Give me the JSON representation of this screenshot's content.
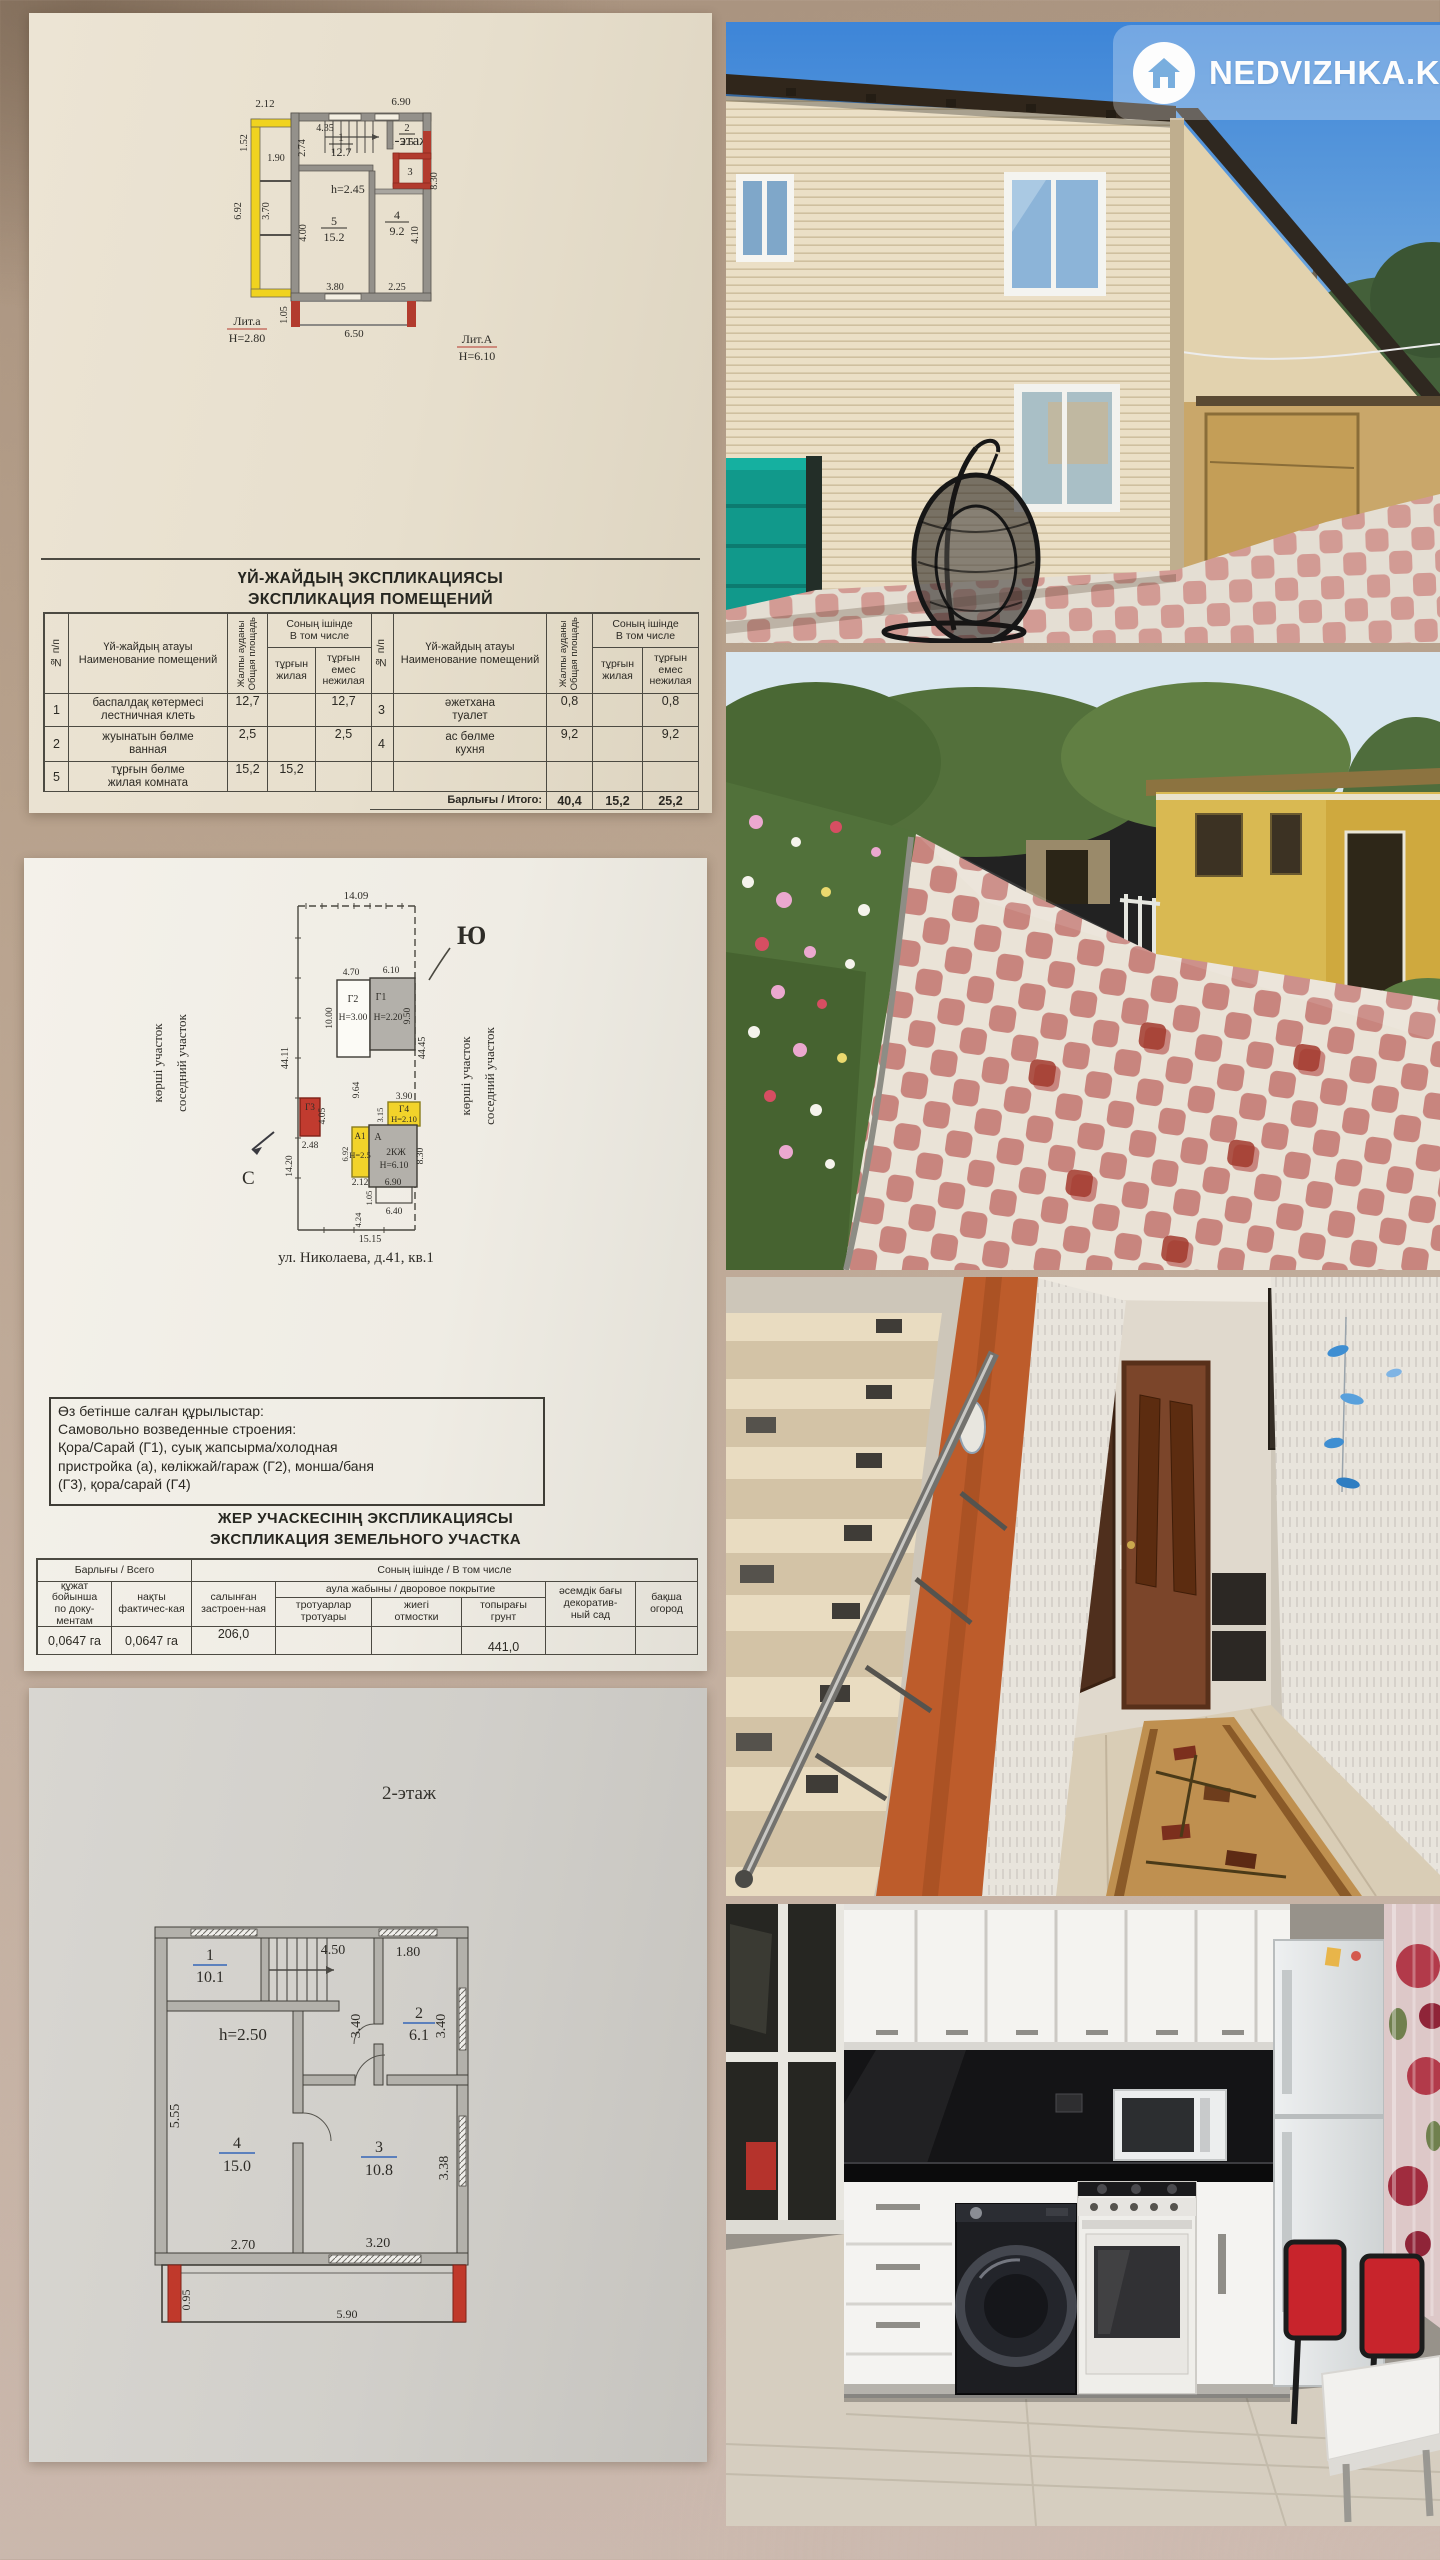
{
  "watermark": {
    "brand": "NEDVIZHKA.KZ"
  },
  "doc1": {
    "plan_title": "1-этаж",
    "labels": {
      "height_note": "h=2.45",
      "lit_small": "Лит.а",
      "lit_small_h": "Н=2.80",
      "lit_big": "Лит.А",
      "lit_big_h": "Н=6.10"
    },
    "rooms": {
      "r1_num": "1",
      "r1_area": "12.7",
      "r2_num": "2",
      "r2_area": "2.5",
      "r3_num": "3",
      "r4_num": "4",
      "r4_area": "9.2",
      "r5_num": "5",
      "r5_area": "15.2"
    },
    "dims": {
      "d212": "2.12",
      "d690": "6.90",
      "d152": "1.52",
      "d190": "1.90",
      "d692": "6.92",
      "d370": "3.70",
      "d435": "4.35",
      "d274": "2.74",
      "d400": "4.00",
      "d380": "3.80",
      "d225": "2.25",
      "d830": "8.30",
      "d410": "4.10",
      "d105": "1.05",
      "d650": "6.50"
    },
    "table": {
      "title1": "ҮЙ-ЖАЙДЫҢ ЭКСПЛИКАЦИЯСЫ",
      "title2": "ЭКСПЛИКАЦИЯ ПОМЕЩЕНИЙ",
      "h_no": "№ п/п",
      "h_name": "Үй-жайдың атауы\nНаименование помещений",
      "h_area": "Жалпы ауданы\nОбщая площадь",
      "h_incl": "Соның ішінде\nВ том числе",
      "h_living": "тұрғын\nжилая",
      "h_nonliving": "тұрғын емес\nнежилая",
      "left_rows": [
        {
          "num": "1",
          "name": "баспалдақ көтермесі\nлестничная клеть",
          "total": "12,7",
          "living": "",
          "nonliving": "12,7"
        },
        {
          "num": "2",
          "name": "жуынатын бөлме\nванная",
          "total": "2,5",
          "living": "",
          "nonliving": "2,5"
        },
        {
          "num": "5",
          "name": "тұрғын бөлме\nжилая комната",
          "total": "15,2",
          "living": "15,2",
          "nonliving": ""
        }
      ],
      "right_rows": [
        {
          "num": "3",
          "name": "әжетхана\nтуалет",
          "total": "0,8",
          "living": "",
          "nonliving": "0,8"
        },
        {
          "num": "4",
          "name": "ас бөлме\nкухня",
          "total": "9,2",
          "living": "",
          "nonliving": "9,2"
        }
      ],
      "total_label": "Барлығы / Итого:",
      "totals": {
        "all": "40,4",
        "living": "15,2",
        "nonliving": "25,2"
      }
    }
  },
  "doc2": {
    "south": "Ю",
    "north": "С",
    "neighbor_kz": "көрші участок",
    "neighbor_ru": "соседний участок",
    "dims": {
      "top": "14.09",
      "left": "44.11",
      "right": "44.45",
      "g2w": "4.70",
      "g1w": "6.10",
      "g2d": "10.00",
      "g1d": "9.50",
      "mid": "9.64",
      "g3w": "2.48",
      "g3d": "4.05",
      "left2": "14.20",
      "g4w": "3.90",
      "g4d": "3.15",
      "a1d": "6.92",
      "a1w": "2.12",
      "aw": "6.90",
      "ad": "8.30",
      "ph": "1.05",
      "pw": "6.40",
      "bl": "4.24",
      "bottom": "15.15"
    },
    "bld": {
      "g1": "Г1",
      "g1h": "Н=2.20",
      "g2": "Г2",
      "g2h": "Н=3.00",
      "g3": "Г3",
      "g4": "Г4",
      "g4h": "Н=2.10",
      "a1": "А1",
      "a1h": "Н=2.5",
      "a": "А",
      "atype": "2КЖ",
      "ah": "Н=6.10"
    },
    "caption": "ул. Николаева, д.41, кв.1",
    "note": {
      "l1": "Өз бетінше салған құрылыстар:",
      "l2": "Самовольно возведенные строения:",
      "l3": " Қора/Сарай (Г1), суық жапсырма/холодная",
      "l4": "пристройка (а), көлікжай/гараж (Г2), монша/баня",
      "l5": "(Г3), қора/сарай (Г4)"
    },
    "table": {
      "title1": "ЖЕР УЧАСКЕСІНІҢ ЭКСПЛИКАЦИЯСЫ",
      "title2": "ЭКСПЛИКАЦИЯ ЗЕМЕЛЬНОГО УЧАСТКА",
      "g_total": "Барлығы / Всего",
      "g_incl": "Соның ішінде / В том числе",
      "c1": "құжат\nбойынша\nпо доку-\nментам",
      "c2": "нақты\nфактичес-кая",
      "c3": "салынған\nзастроен-ная",
      "g_yard": "аула жабыны / дворовое покрытие",
      "c4": "тротуарлар\nтротуары",
      "c5": "жиегі\nотмостки",
      "c6": "топырағы\nгрунт",
      "c7": "әсемдік бағы\nдекоратив-\nный сад",
      "c8": "бақша\nогород",
      "v1": "0,0647 га",
      "v2": "0,0647 га",
      "v3": "206,0",
      "v4": "",
      "v5": "",
      "v6": "441,0",
      "v7": "",
      "v8": ""
    }
  },
  "doc3": {
    "title": "2-этаж",
    "height_note": "h=2.50",
    "rooms": {
      "r1_num": "1",
      "r1_area": "10.1",
      "r2_num": "2",
      "r2_area": "6.1",
      "r3_num": "3",
      "r3_area": "10.8",
      "r4_num": "4",
      "r4_area": "15.0"
    },
    "dims": {
      "t1": "4.50",
      "t2": "1.80",
      "m1": "3.40",
      "m2": "3.40",
      "left": "5.55",
      "right": "3.38",
      "b1": "2.70",
      "b2": "3.20",
      "balh": "0.95",
      "balw": "5.90"
    }
  }
}
